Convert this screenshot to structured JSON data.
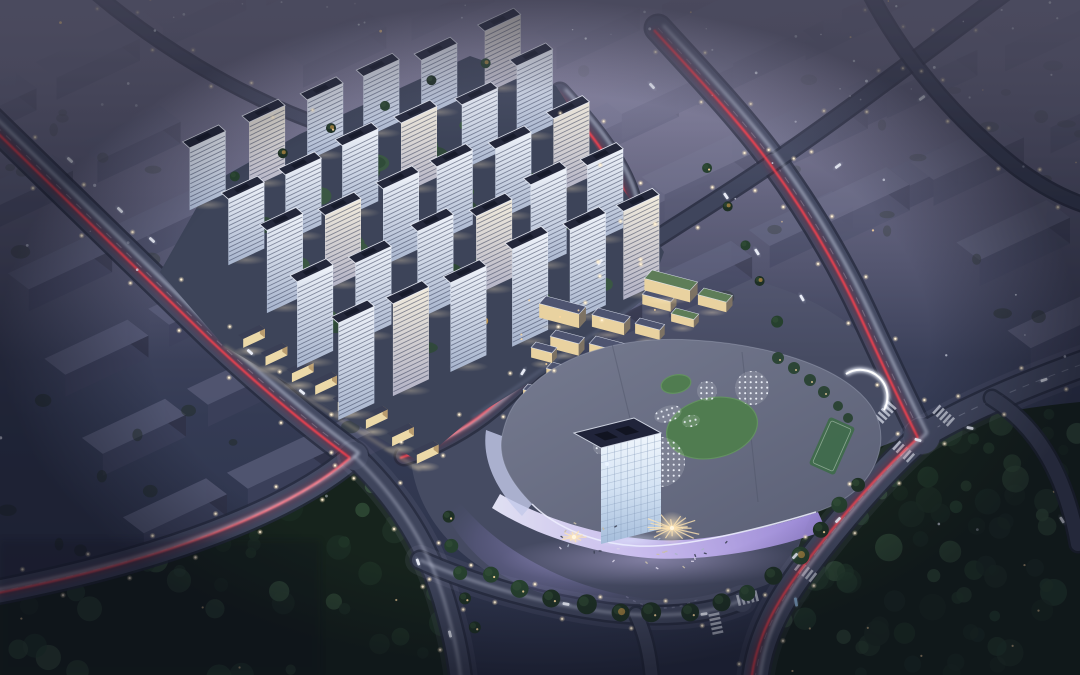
{
  "meta": {
    "description": "Aerial night rendering of a mixed-use development: lit residential high-rise towers, a curved illuminated shopping mall with rooftop lawns and skylight pads, avenues with red tail-light trails, surrounded by dark hazy context city blocks and parkland",
    "width": 1080,
    "height": 675
  },
  "palette": {
    "sky": {
      "top": "#666480",
      "mid": "#4b4d67",
      "low": "#343b54",
      "bot": "#2b3148"
    },
    "haze": "#8d8aa6",
    "road": {
      "casing": "#262b3d",
      "major": "#444a62",
      "minor": "#3f455c",
      "dash": "#b9c0d4",
      "sidewalk": "#9aa1b8"
    },
    "trail": {
      "red": "#ff4350",
      "red2": "#a81e2e",
      "white": "#e8edff"
    },
    "light": {
      "warm": "#ffd9a0",
      "core": "#fff3da"
    },
    "forest": {
      "base": "#16231c",
      "b1": "#1e3025",
      "b2": "#26402e",
      "hi": "#35523a"
    },
    "site": {
      "ground": "#3d4459",
      "green": "#2e4936",
      "green2": "#3a5a40",
      "autumn": "#c19244",
      "autumn2": "#a06a2e",
      "pool": "#57c4e6"
    },
    "tower": {
      "front_top": "#eef2f9",
      "front_bot": "#a7b4cd",
      "stripe": "#2c3450",
      "roof": "#23273a",
      "roof_edge": "#eef2fb"
    },
    "retail": {
      "roof": "#3a3f55",
      "front": "#ecd9a8"
    },
    "village": {
      "roof": "#4e5470",
      "roof_green": "#5e7d58",
      "front": "#e9d2a0",
      "end": "#7d7263",
      "parapet": "#e8ecf8"
    },
    "mall": {
      "roof_a": "#767b90",
      "roof_b": "#595e74",
      "lawn": "#507c50",
      "lawn2": "#639161",
      "court": "#3e6b49",
      "dot": "#eef2fa",
      "ground": "#474c63"
    },
    "cube": {
      "roof": "#20243a",
      "grid": "#7f95b5"
    },
    "plaza": {
      "burst": "#ffe4b2"
    },
    "car": {
      "white": "#eef1fb",
      "blue": "#8fb8dc"
    }
  },
  "scene": {
    "dirs": {
      "ctxU": [
        0.905,
        -0.425
      ],
      "ctxV": [
        0.55,
        0.42
      ],
      "vilU": [
        0.95,
        0.25
      ],
      "vilV": [
        -0.38,
        0.42
      ],
      "twrU": [
        0.9,
        -0.42
      ],
      "twrV": [
        0.52,
        0.46
      ]
    },
    "mall_ground_d": "M 474,302 C 560,264 656,258 736,276 C 810,292 862,324 888,368 C 906,400 908,440 890,478 C 868,524 824,560 768,584 C 700,612 600,612 524,588 C 456,564 420,516 412,468 C 406,420 424,348 474,302 Z",
    "context_grids": [
      {
        "name": "context-blocks-northwest",
        "origin": [
          -68,
          132
        ],
        "col_step": [
          105,
          -48
        ],
        "row_step": [
          38,
          82
        ],
        "cols": 8,
        "rows": 6,
        "slab": [
          92,
          38,
          22
        ],
        "skip": 0.06,
        "colors": {
          "top": "#515571",
          "front": "#3b3f5a",
          "side": "#2f3349"
        },
        "opacity": 0.95
      },
      {
        "name": "context-blocks-northeast",
        "origin": [
          484,
          171
        ],
        "col_step": [
          112,
          -51
        ],
        "row_step": [
          46,
          84
        ],
        "cols": 9,
        "rows": 7,
        "slab": [
          100,
          42,
          26
        ],
        "skip": 0.05,
        "exclude": [
          430,
          270,
          920,
          620
        ],
        "colors": {
          "top": "#585c76",
          "front": "#40445f",
          "side": "#33374e"
        },
        "opacity": 0.95
      }
    ],
    "grid_groves": [
      {
        "bbox": [
          0,
          70,
          600,
          250
        ],
        "n": 22
      },
      {
        "bbox": [
          640,
          60,
          440,
          260
        ],
        "n": 22
      },
      {
        "bbox": [
          0,
          400,
          400,
          170
        ],
        "n": 16
      }
    ],
    "forests": [
      {
        "name": "park-forest-southeast",
        "d": "M 836,468 C 900,432 990,410 1080,402 L 1080,675 L 768,675 C 776,612 800,522 836,468 Z",
        "bbox": [
          770,
          400,
          310,
          275
        ],
        "blobs": 95,
        "lights": 10
      },
      {
        "name": "roadside-forest-southwest",
        "d": "M -10,600 C 140,568 262,540 352,470 C 392,506 420,558 442,612 L 452,678 L -10,678 Z",
        "bbox": [
          -10,
          470,
          465,
          208
        ],
        "blobs": 70,
        "lights": 8
      }
    ],
    "roads": [
      {
        "id": "avenue-west",
        "d": "M -14,116 L 213,337 C 282,402 330,438 354,456",
        "w": 26,
        "major": true,
        "lights": true,
        "trails": "red"
      },
      {
        "id": "avenue-west-south",
        "d": "M 354,456 C 292,510 166,560 -14,594",
        "w": 22,
        "major": true,
        "lights": true,
        "trails": "red"
      },
      {
        "id": "mall-west-road",
        "d": "M 354,456 C 398,498 428,546 444,600 C 452,628 458,652 461,680",
        "w": 20,
        "major": false,
        "lights": true,
        "trails": "white",
        "sidewalk": true
      },
      {
        "id": "inner-road",
        "d": "M 560,92 C 612,148 644,198 632,242 C 618,290 566,344 492,408 C 468,428 436,446 404,456",
        "w": 16,
        "major": false,
        "lights": true,
        "trails": "red"
      },
      {
        "id": "avenue-east",
        "d": "M 658,28 C 700,74 742,118 774,162 C 806,206 838,258 864,314 C 888,366 908,408 922,436",
        "w": 24,
        "major": true,
        "lights": true,
        "trails": "red"
      },
      {
        "id": "avenue-east-south",
        "d": "M 922,436 C 884,470 842,518 806,566 C 782,598 760,634 755,680",
        "w": 24,
        "major": true,
        "lights": true,
        "trails": "red",
        "sidewalk": true
      },
      {
        "id": "cross-avenue",
        "d": "M 922,436 C 962,412 1020,386 1094,360",
        "w": 24,
        "major": true,
        "lights": true,
        "trails": null,
        "sidewalk": true
      },
      {
        "id": "slip-road",
        "d": "M 992,398 C 1040,428 1066,478 1078,544",
        "w": 14,
        "major": false,
        "lights": false,
        "trails": null
      },
      {
        "id": "ne-grid-road",
        "d": "M 1008,-10 C 930,48 850,110 774,162 C 722,198 668,230 612,268 C 586,286 566,300 552,312",
        "w": 14,
        "major": false,
        "lights": true,
        "trails": null
      },
      {
        "id": "nw-top-road",
        "d": "M 92,-10 C 150,40 236,96 330,128",
        "w": 10,
        "major": false,
        "lights": true,
        "trails": null
      },
      {
        "id": "mall-south-road",
        "d": "M 420,560 C 478,586 546,604 606,612 C 656,618 706,616 742,600",
        "w": 16,
        "major": false,
        "lights": true,
        "trails": "white",
        "sidewalk": true
      },
      {
        "id": "south-exit-road",
        "d": "M 636,614 C 646,636 650,656 652,680",
        "w": 12,
        "major": false,
        "lights": false,
        "trails": null
      },
      {
        "id": "ne-corner-road",
        "d": "M 868,-10 C 902,56 952,116 1014,166 C 1040,186 1066,200 1094,208",
        "w": 12,
        "major": false,
        "lights": true,
        "trails": null
      }
    ],
    "junctions": [
      [
        354,
        456,
        14
      ],
      [
        922,
        436,
        18
      ],
      [
        742,
        602,
        10
      ],
      [
        772,
        162,
        8
      ]
    ],
    "crosswalks": [
      [
        806,
        572,
        38
      ],
      [
        748,
        598,
        -14
      ],
      [
        904,
        452,
        42
      ],
      [
        944,
        416,
        42
      ],
      [
        886,
        412,
        -48
      ],
      [
        716,
        624,
        78
      ]
    ],
    "residential": {
      "ground_d": "M 160,272 L 210,184 L 300,134 L 470,56 L 556,86 L 664,252 L 648,296 L 566,360 L 472,418 L 420,462 L 224,346 Z",
      "towers": {
        "origin": [
          205,
          205
        ],
        "col_step": [
          58,
          -24
        ],
        "row_step": [
          36,
          52
        ],
        "cols": 6,
        "rows": 5,
        "w": 40,
        "d": 13.5,
        "h_base": 64,
        "h_row": 7,
        "h_jit": 7
      },
      "retail": {
        "from": [
          236,
          344
        ],
        "to": [
          410,
          458
        ],
        "n": 8
      }
    },
    "village": {
      "boxes": [
        [
          546,
          310,
          42,
          18,
          14,
          "n"
        ],
        [
          598,
          320,
          34,
          16,
          12,
          "n"
        ],
        [
          556,
          342,
          30,
          15,
          12,
          "n"
        ],
        [
          596,
          350,
          40,
          18,
          14,
          "n"
        ],
        [
          552,
          374,
          32,
          15,
          12,
          "n"
        ],
        [
          600,
          384,
          30,
          15,
          12,
          "n"
        ],
        [
          640,
          328,
          26,
          13,
          10,
          "n"
        ],
        [
          636,
          360,
          28,
          15,
          12,
          "n"
        ],
        [
          536,
          352,
          22,
          13,
          10,
          "n"
        ],
        [
          648,
          298,
          30,
          15,
          10,
          "n"
        ],
        [
          528,
          396,
          26,
          13,
          12,
          "n"
        ],
        [
          572,
          406,
          30,
          15,
          10,
          "n"
        ],
        [
          616,
          408,
          26,
          13,
          10,
          "n"
        ],
        [
          658,
          388,
          24,
          13,
          10,
          "n"
        ],
        [
          652,
          282,
          48,
          20,
          12,
          "g"
        ],
        [
          704,
          298,
          30,
          16,
          10,
          "g"
        ],
        [
          676,
          316,
          24,
          13,
          8,
          "g"
        ]
      ],
      "lane_lights_bbox": [
        515,
        300,
        170,
        115
      ]
    },
    "mall": {
      "podium_d": "M 525,392 C 560,354 622,336 692,340 C 762,344 822,362 854,388 C 874,404 884,424 880,448 C 874,478 852,500 816,512 C 770,526 700,544 654,546 C 608,548 560,532 532,504 C 508,480 498,458 502,436 C 506,418 512,404 525,392 Z",
      "seams": [
        "M 612,344 L 642,468",
        "M 742,352 L 758,502"
      ],
      "band_south_d": "M 500,494 C 546,520 602,536 654,540 C 702,543 770,528 818,512 L 826,530 C 774,550 704,562 648,558 C 592,553 536,536 492,508 Z",
      "band_west_d": "M 502,436 C 498,458 508,480 532,504 L 522,516 C 494,488 482,458 486,430 Z",
      "parapet_d": "M 532,504 C 560,532 608,548 654,546 C 700,544 770,526 816,512",
      "canopy_d": "M 846,374 A 27 27 0 0 1 884,410",
      "pads": [
        [
          752,
          388,
          17
        ],
        [
          707,
          391,
          10
        ],
        [
          660,
          462,
          25
        ],
        [
          628,
          431,
          11
        ],
        [
          600,
          447,
          7
        ]
      ],
      "pad_ellipses": [
        [
          668,
          414,
          14,
          8,
          -18
        ],
        [
          691,
          421,
          9,
          6,
          -12
        ]
      ],
      "lawns": [
        [
          712,
          428,
          46,
          30,
          -12
        ],
        [
          676,
          384,
          15,
          9,
          -12
        ]
      ],
      "court": {
        "x": 832,
        "y": 446,
        "w": 28,
        "h": 52,
        "rot": 24
      },
      "garden": [
        [
          778,
          358,
          6
        ],
        [
          794,
          368,
          6
        ],
        [
          810,
          380,
          6
        ],
        [
          824,
          392,
          6
        ],
        [
          838,
          406,
          5
        ],
        [
          848,
          418,
          5
        ]
      ],
      "cube": {
        "p": [
          574,
          529
        ],
        "u": [
          60,
          -15
        ],
        "v": [
          27,
          15
        ],
        "h": 96
      },
      "plaza_d": "M 438,470 C 462,514 504,552 566,578 C 622,600 676,606 722,596 L 710,610 C 654,620 586,612 528,588 C 472,566 444,520 432,480 Z",
      "bursts": [
        [
          672,
          528,
          30,
          18
        ],
        [
          574,
          537,
          13,
          10
        ]
      ]
    },
    "tree_rows": [
      {
        "name": "mall-south-trees",
        "pts": [
          [
            492,
            576,
            8
          ],
          [
            520,
            588,
            9
          ],
          [
            552,
            598,
            9
          ],
          [
            586,
            606,
            10
          ],
          [
            620,
            612,
            9
          ],
          [
            654,
            614,
            10
          ],
          [
            688,
            612,
            9
          ],
          [
            720,
            604,
            9
          ],
          [
            748,
            592,
            8
          ],
          [
            774,
            576,
            9
          ],
          [
            800,
            554,
            9
          ],
          [
            822,
            530,
            8
          ],
          [
            842,
            506,
            8
          ],
          [
            858,
            484,
            7
          ]
        ]
      },
      {
        "name": "mall-west-trees",
        "pts": [
          [
            448,
            516,
            6
          ],
          [
            452,
            544,
            7
          ],
          [
            458,
            572,
            7
          ],
          [
            466,
            600,
            6
          ],
          [
            476,
            626,
            6
          ]
        ]
      },
      {
        "name": "site-north-trees",
        "pts": [
          [
            232,
            176,
            5
          ],
          [
            280,
            152,
            5
          ],
          [
            330,
            128,
            5
          ],
          [
            382,
            104,
            5
          ],
          [
            434,
            80,
            5
          ],
          [
            486,
            62,
            5
          ]
        ]
      },
      {
        "name": "avenue-east-trees",
        "pts": [
          [
            706,
            170,
            5
          ],
          [
            726,
            206,
            5
          ],
          [
            744,
            244,
            5
          ],
          [
            762,
            282,
            5
          ],
          [
            778,
            320,
            6
          ]
        ]
      }
    ],
    "cars": [
      [
        70,
        160,
        43,
        "w"
      ],
      [
        152,
        240,
        43,
        "w"
      ],
      [
        302,
        392,
        40,
        "w"
      ],
      [
        418,
        562,
        70,
        "w"
      ],
      [
        450,
        634,
        76,
        "w"
      ],
      [
        566,
        604,
        10,
        "w"
      ],
      [
        704,
        614,
        -8,
        "w"
      ],
      [
        796,
        602,
        80,
        "b"
      ],
      [
        795,
        556,
        -48,
        "w"
      ],
      [
        838,
        520,
        -46,
        "w"
      ],
      [
        918,
        440,
        16,
        "w"
      ],
      [
        970,
        428,
        12,
        "w"
      ],
      [
        1044,
        380,
        -20,
        "w"
      ],
      [
        757,
        252,
        58,
        "w"
      ],
      [
        802,
        298,
        60,
        "w"
      ],
      [
        726,
        196,
        56,
        "w"
      ],
      [
        838,
        166,
        -37,
        "w"
      ],
      [
        922,
        98,
        -37,
        "w"
      ],
      [
        652,
        86,
        48,
        "w"
      ],
      [
        600,
        262,
        -52,
        "w"
      ],
      [
        523,
        372,
        -58,
        "w"
      ],
      [
        1062,
        520,
        58,
        "w"
      ],
      [
        250,
        352,
        42,
        "w"
      ],
      [
        120,
        210,
        44,
        "w"
      ]
    ],
    "stars": {
      "count": 130
    }
  }
}
